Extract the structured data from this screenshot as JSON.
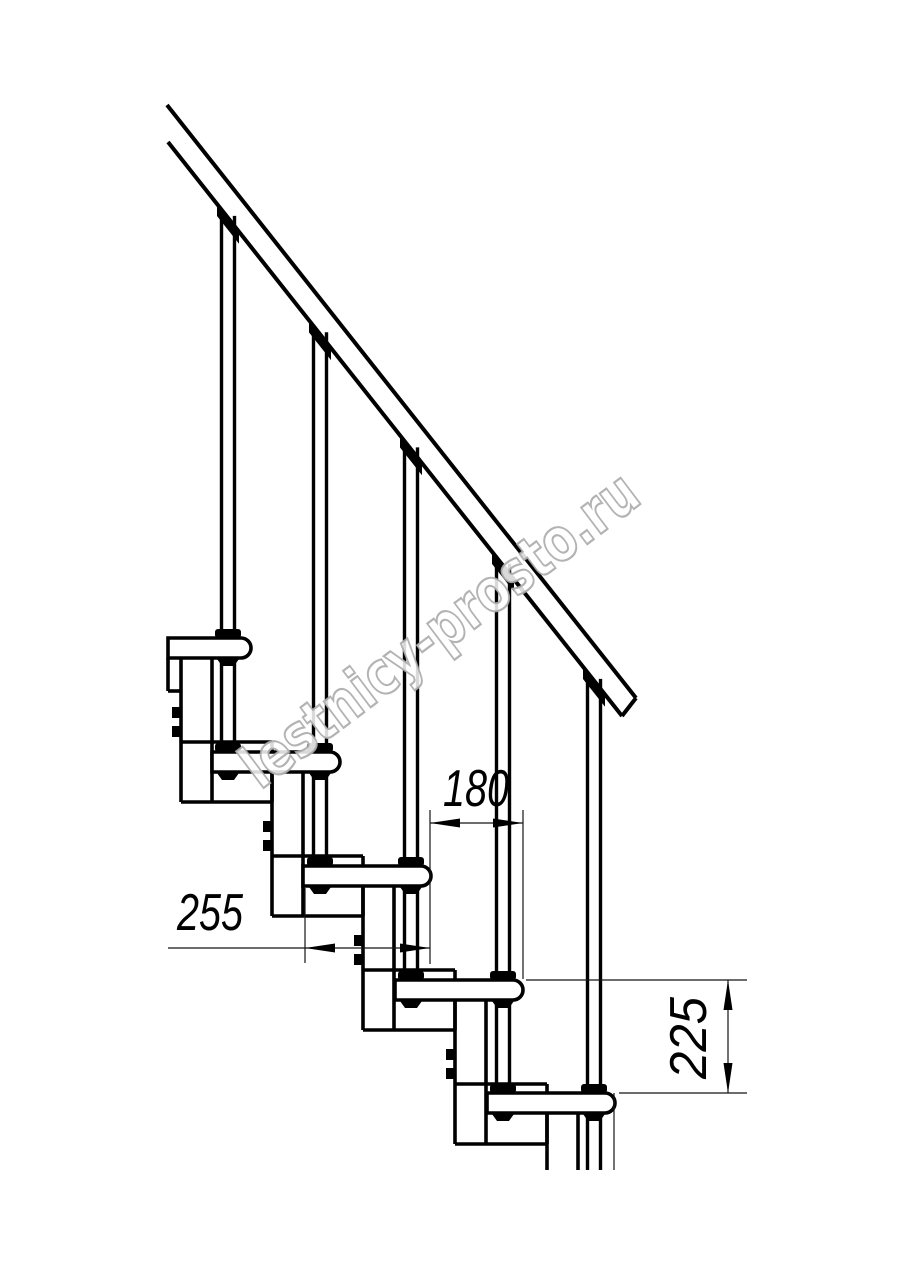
{
  "drawing": {
    "type": "staircase-side-view-technical-drawing",
    "dimensions": {
      "spacing_180": "180",
      "run_255": "255",
      "rise_225": "225"
    },
    "watermark": "lestnicy-prosto.ru",
    "colors": {
      "line": "#000000",
      "thin_line": "#141414",
      "background": "#ffffff",
      "watermark_outline": "#ababab"
    }
  }
}
